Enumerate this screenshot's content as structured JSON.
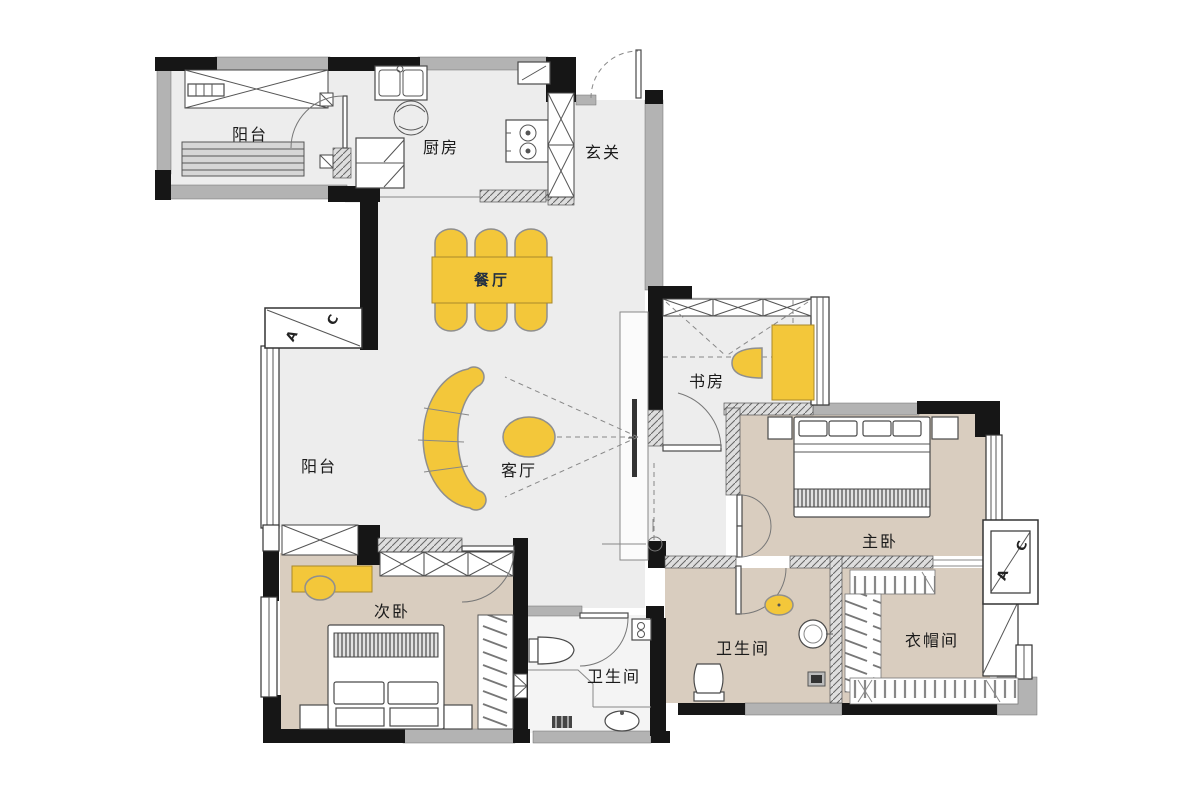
{
  "plan": {
    "rooms": {
      "balcony_top": {
        "label": "阳台"
      },
      "kitchen": {
        "label": "厨房"
      },
      "entry": {
        "label": "玄关"
      },
      "dining": {
        "label": "餐厅"
      },
      "study": {
        "label": "书房"
      },
      "balcony_living": {
        "label": "阳台"
      },
      "living": {
        "label": "客厅"
      },
      "master_bedroom": {
        "label": "主卧"
      },
      "second_bedroom": {
        "label": "次卧"
      },
      "bathroom_main": {
        "label": "卫生间"
      },
      "bathroom_master": {
        "label": "卫生间"
      },
      "closet": {
        "label": "衣帽间"
      }
    },
    "ac_units": {
      "left": {
        "a": "A",
        "c": "C"
      },
      "right": {
        "a": "A",
        "c": "C"
      }
    },
    "colors": {
      "furniture_accent": "#f3c73a",
      "floor_light": "#ededed",
      "floor_tan": "#d9cdbf",
      "wall": "#161616",
      "wall_secondary": "#b3b3b3"
    }
  }
}
